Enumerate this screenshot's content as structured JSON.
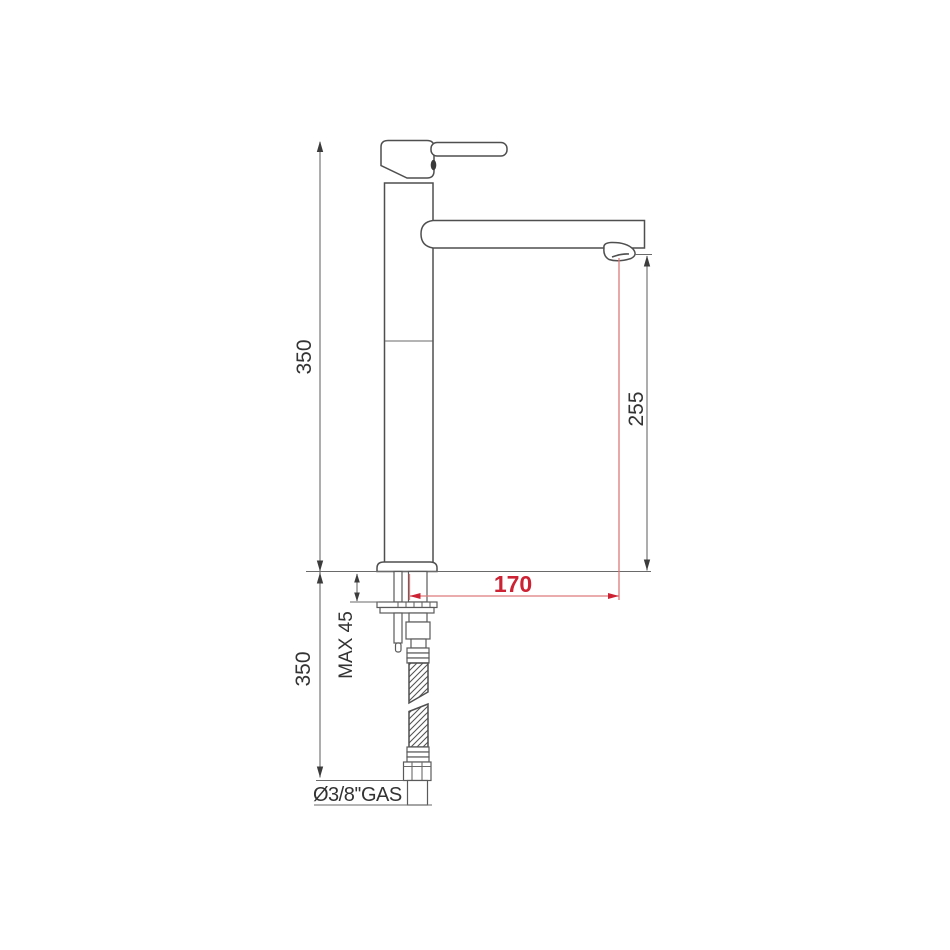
{
  "drawing": {
    "type": "technical-dimension-drawing",
    "subject": "tall single-lever basin mixer tap, side view with installation dimensions"
  },
  "colors": {
    "background": "#ffffff",
    "outline": "#4f4f4f",
    "dimension": "#6a6a6a",
    "text": "#333333",
    "accent_red_text": "#cc2233",
    "accent_red_line": "#dd7a7a"
  },
  "dims": {
    "height_above_counter": "350",
    "spout_outlet_height": "255",
    "spout_reach": "170",
    "max_counter_thickness": "MAX 45",
    "hose_length_below_counter": "350",
    "connection_thread": "Ø3/8''GAS"
  }
}
